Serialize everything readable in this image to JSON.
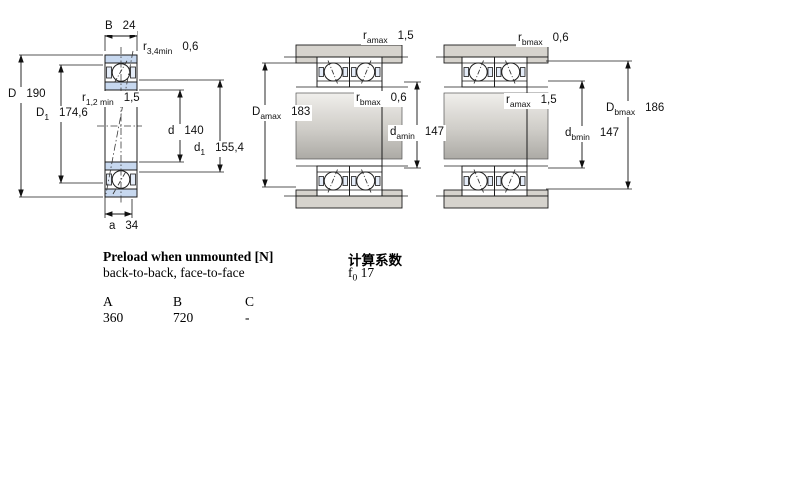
{
  "dim_labels": {
    "left": {
      "B": {
        "sym": "B",
        "sub": "",
        "val": "24"
      },
      "r34": {
        "sym": "r",
        "sub": "3,4min",
        "val": "0,6"
      },
      "D": {
        "sym": "D",
        "sub": "",
        "val": "190"
      },
      "D1": {
        "sym": "D",
        "sub": "1",
        "val": "174,6"
      },
      "r12": {
        "sym": "r",
        "sub": "1,2 min",
        "val": "1,5"
      },
      "d": {
        "sym": "d",
        "sub": "",
        "val": "140"
      },
      "d1": {
        "sym": "d",
        "sub": "1",
        "val": "155,4"
      },
      "a": {
        "sym": "a",
        "sub": "",
        "val": "34"
      }
    },
    "middle": {
      "ramax": {
        "sym": "r",
        "sub": "amax",
        "val": "1,5"
      },
      "rbmax": {
        "sym": "r",
        "sub": "bmax",
        "val": "0,6"
      },
      "Damax": {
        "sym": "D",
        "sub": "amax",
        "val": "183"
      },
      "damin": {
        "sym": "d",
        "sub": "amin",
        "val": "147"
      }
    },
    "right": {
      "rbmax": {
        "sym": "r",
        "sub": "bmax",
        "val": "0,6"
      },
      "ramax": {
        "sym": "r",
        "sub": "amax",
        "val": "1,5"
      },
      "Dbmax": {
        "sym": "D",
        "sub": "bmax",
        "val": "186"
      },
      "dbmin": {
        "sym": "d",
        "sub": "bmin",
        "val": "147"
      }
    }
  },
  "text": {
    "preload_title": "Preload when unmounted [N]",
    "preload_sub": "back-to-back, face-to-face",
    "calc_title": "计算系数",
    "f0": {
      "sym": "f",
      "sub": "0",
      "val": "17"
    },
    "table": {
      "headers": [
        "A",
        "B",
        "C"
      ],
      "values": [
        "360",
        "720",
        "-"
      ]
    }
  },
  "colors": {
    "ring_blue": "#c7d8ef",
    "housing_gray": "#d6d3cd",
    "line": "#1c1c1c"
  }
}
